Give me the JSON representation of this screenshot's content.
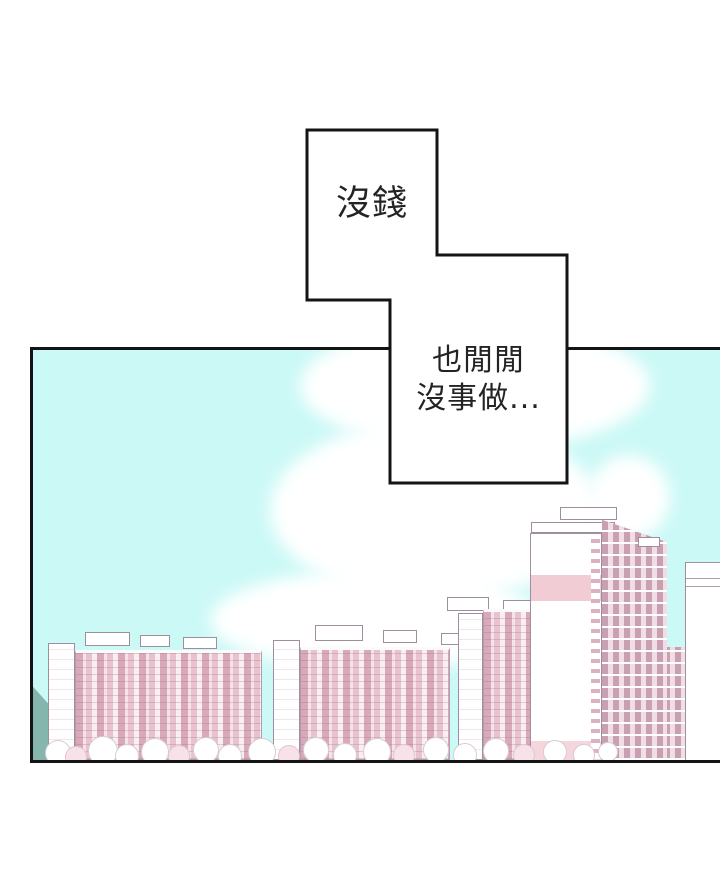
{
  "captions": {
    "box1": {
      "text": "沒錢"
    },
    "box2": {
      "line1": "也閒閒",
      "line2": "沒事做..."
    }
  },
  "colors": {
    "page_background": "#ffffff",
    "panel_border": "#141414",
    "caption_border": "#141414",
    "caption_fill": "#ffffff",
    "caption_text": "#232323",
    "sky": "#cbf9f6",
    "cloud": "#ffffff",
    "hill_teal": "#84b6ae",
    "building_outline": "#a08e9e",
    "facade_window_pink": "#d9a9ba",
    "facade_light_pink": "#f6e3e9",
    "tower_band_pink": "#f2ccd4",
    "tower_face": "#ffffff",
    "bush_fill": "#ffffff"
  }
}
